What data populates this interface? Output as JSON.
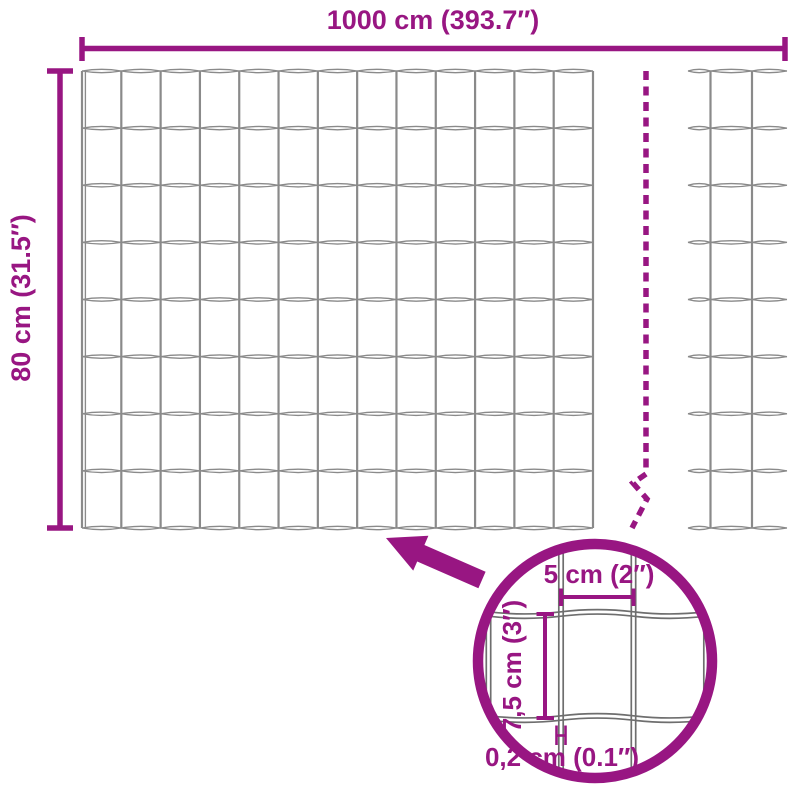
{
  "colors": {
    "accent": "#981682",
    "wire": "#8a8a8a",
    "wire_detail": "#6e6e6e",
    "background": "#ffffff"
  },
  "labels": {
    "total_width": "1000 cm (393.7″)",
    "total_height": "80 cm (31.5″)",
    "mesh_width": "5 cm (2″)",
    "mesh_height": "7,5 cm (3″)",
    "wire_thickness": "0,2 cm (0.1″)"
  },
  "diagram": {
    "subject": "garden wire mesh fence dimensions",
    "total_width_cm": 1000,
    "total_width_in": 393.7,
    "total_height_cm": 80,
    "total_height_in": 31.5,
    "mesh_width_cm": 5,
    "mesh_width_in": 2,
    "mesh_height_cm": 7.5,
    "mesh_height_in": 3,
    "wire_thickness_cm": 0.2,
    "wire_thickness_in": 0.1
  }
}
